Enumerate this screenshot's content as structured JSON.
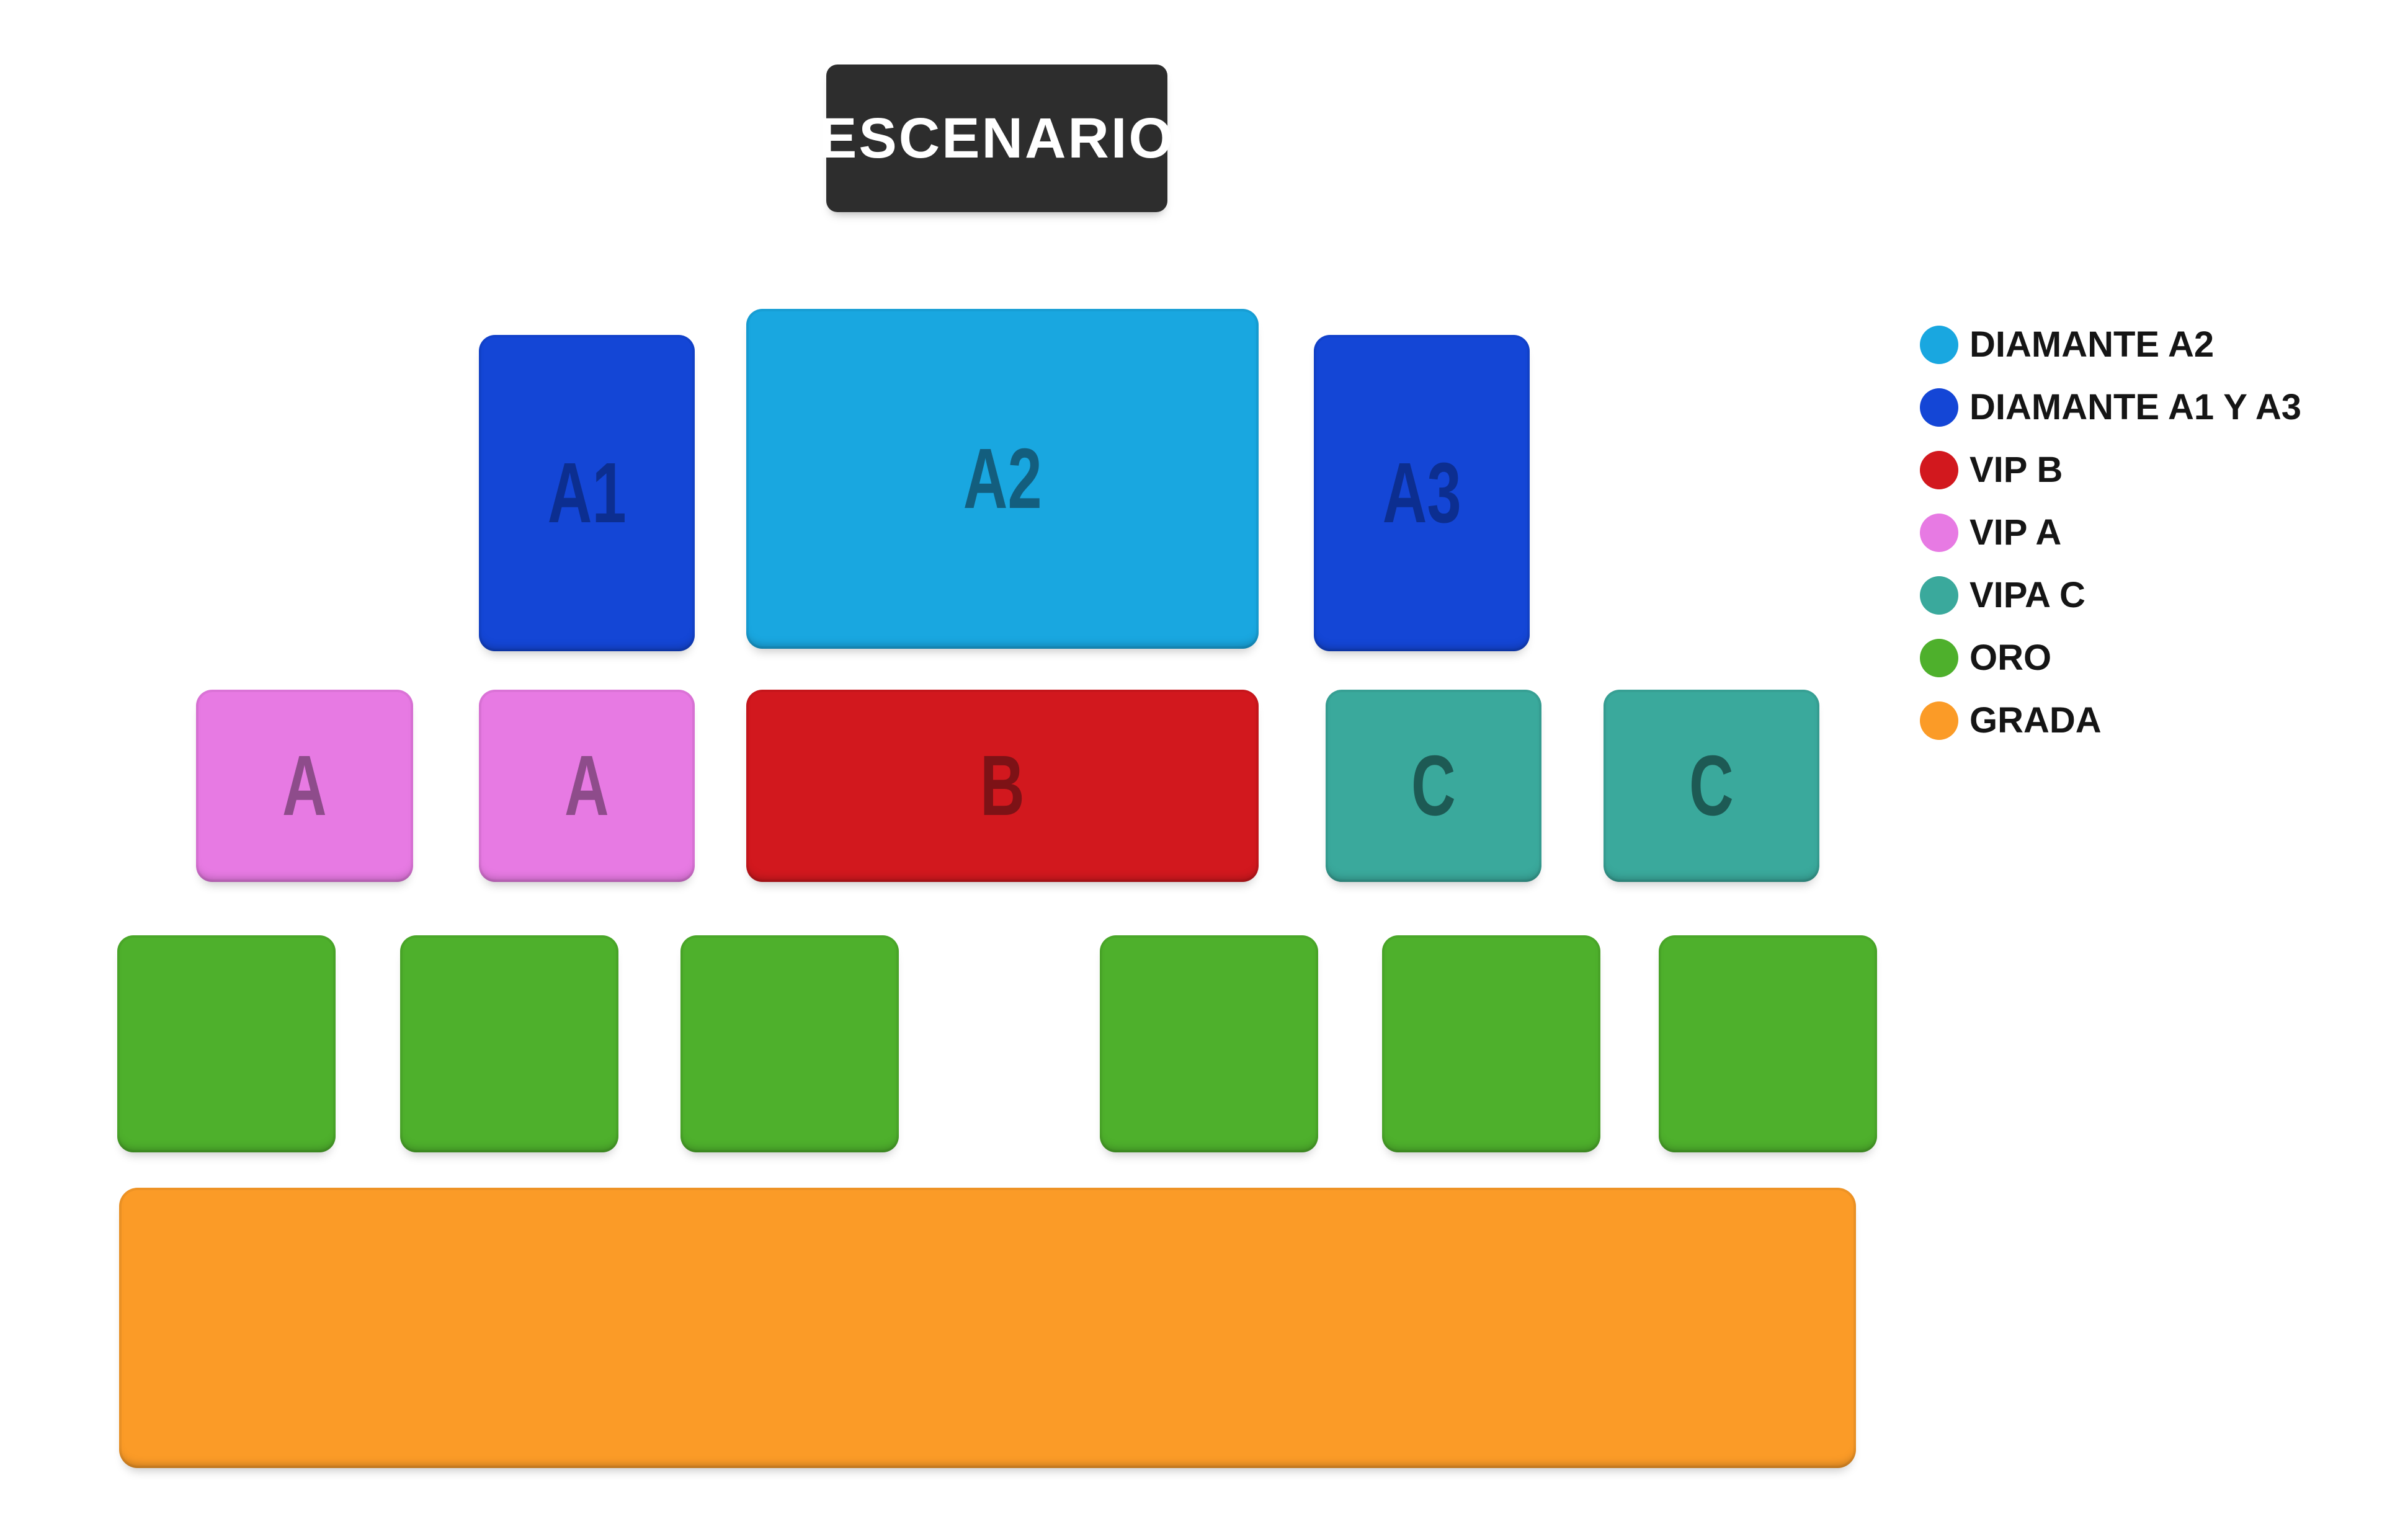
{
  "page": {
    "background": "#ffffff",
    "type": "venue-seating-map"
  },
  "stage": {
    "label": "ESCENARIO",
    "bg": "#2d2d2d",
    "text_color": "#ffffff"
  },
  "map": {
    "sections": {
      "a1": {
        "label": "A1",
        "color": "#1446d6"
      },
      "a2": {
        "label": "A2",
        "color": "#19a7e0"
      },
      "a3": {
        "label": "A3",
        "color": "#1446d6"
      },
      "vip_a_left": {
        "label": "A",
        "color": "#e77ae3"
      },
      "vip_a_right": {
        "label": "A",
        "color": "#e77ae3"
      },
      "vip_b": {
        "label": "B",
        "color": "#d2181e"
      },
      "vipa_c_left": {
        "label": "C",
        "color": "#3aa99c"
      },
      "vipa_c_right": {
        "label": "C",
        "color": "#3aa99c"
      },
      "oro": {
        "label": "",
        "color": "#4eb02c",
        "block_count": 6
      },
      "grada": {
        "label": "",
        "color": "#fb9b27"
      }
    }
  },
  "legend": {
    "items": [
      {
        "label": "DIAMANTE A2",
        "color": "#19a7e0"
      },
      {
        "label": "DIAMANTE A1 Y A3",
        "color": "#1446d6"
      },
      {
        "label": "VIP B",
        "color": "#d2181e"
      },
      {
        "label": "VIP A",
        "color": "#e77ae3"
      },
      {
        "label": "VIPA C",
        "color": "#3aa99c"
      },
      {
        "label": "ORO",
        "color": "#4eb02c"
      },
      {
        "label": "GRADA",
        "color": "#fb9b27"
      }
    ]
  }
}
